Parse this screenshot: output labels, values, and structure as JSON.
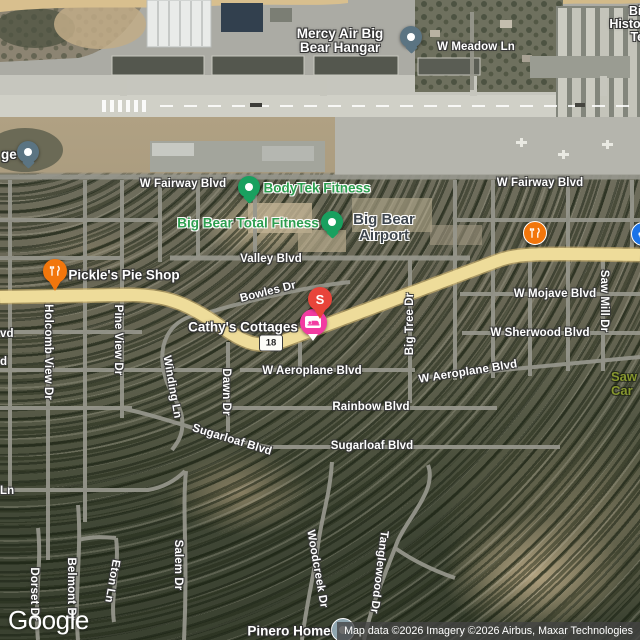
{
  "map": {
    "google_logo": "Google",
    "attribution": "Map data ©2026 Imagery ©2026 Airbus, Maxar Technologies",
    "route_shield": "18",
    "view_type": "satellite"
  },
  "streets": [
    {
      "text": "W Meadow Ln"
    },
    {
      "text": "W Fairway Blvd"
    },
    {
      "text": "W Fairway Blvd"
    },
    {
      "text": "Valley Blvd"
    },
    {
      "text": "Bowles Dr"
    },
    {
      "text": "W Mojave Blvd"
    },
    {
      "text": "W Sherwood Blvd"
    },
    {
      "text": "W Aeroplane Blvd"
    },
    {
      "text": "W Aeroplane Blvd"
    },
    {
      "text": "Rainbow Blvd"
    },
    {
      "text": "Sugarloaf Blvd"
    },
    {
      "text": "Sugarloaf Blvd"
    },
    {
      "text": "Saw Mill Dr"
    },
    {
      "text": "Big Tree Dr"
    },
    {
      "text": "Holcomb View Dr"
    },
    {
      "text": "Pine View Dr"
    },
    {
      "text": "Winding Ln"
    },
    {
      "text": "Dawn Dr"
    },
    {
      "text": "Salem Dr"
    },
    {
      "text": "Woodcreek Dr"
    },
    {
      "text": "Tanglewood Dr"
    },
    {
      "text": "Dorset Dr"
    },
    {
      "text": "Belmont Dr"
    },
    {
      "text": "Eton Ln"
    },
    {
      "text": "Ln"
    },
    {
      "text": "vd"
    },
    {
      "text": "d"
    }
  ],
  "pois": {
    "mercy_air": {
      "line1": "Mercy Air Big",
      "line2": "Bear Hangar"
    },
    "partial_ge": {
      "text": "ge"
    },
    "bodytek": {
      "text": "BodyTek Fitness",
      "color": "#2d9e4f"
    },
    "total_fitness": {
      "text": "Big Bear Total Fitness",
      "color": "#2d9e4f"
    },
    "airport": {
      "line1": "Big Bear",
      "line2": "Airport",
      "color": "#3e464e"
    },
    "pickles": {
      "text": "Pickle's Pie Shop"
    },
    "cathys": {
      "text": "Cathy's Cottages"
    },
    "pinero": {
      "text": "Pinero Home"
    },
    "historic_partial": {
      "line1": "Big",
      "line2": "Histori",
      "line3": "Ter"
    },
    "park_partial": {
      "line1": "Saw",
      "line2": "Car",
      "color": "#87972f"
    }
  },
  "markers": {
    "s_pin": {
      "letter": "S",
      "color": "#e8443a"
    },
    "lodging_pin": {
      "color": "#f23ba1",
      "icon": "bed-icon"
    },
    "gray_poi_pin": {
      "color": "#5b7482"
    },
    "green_poi_pin": {
      "color": "#19a05f"
    },
    "restaurant_pin": {
      "color": "#f2760c",
      "icon": "fork-knife-icon"
    },
    "blue_poi_pin": {
      "color": "#1a73e8",
      "icon": "car-icon"
    }
  }
}
